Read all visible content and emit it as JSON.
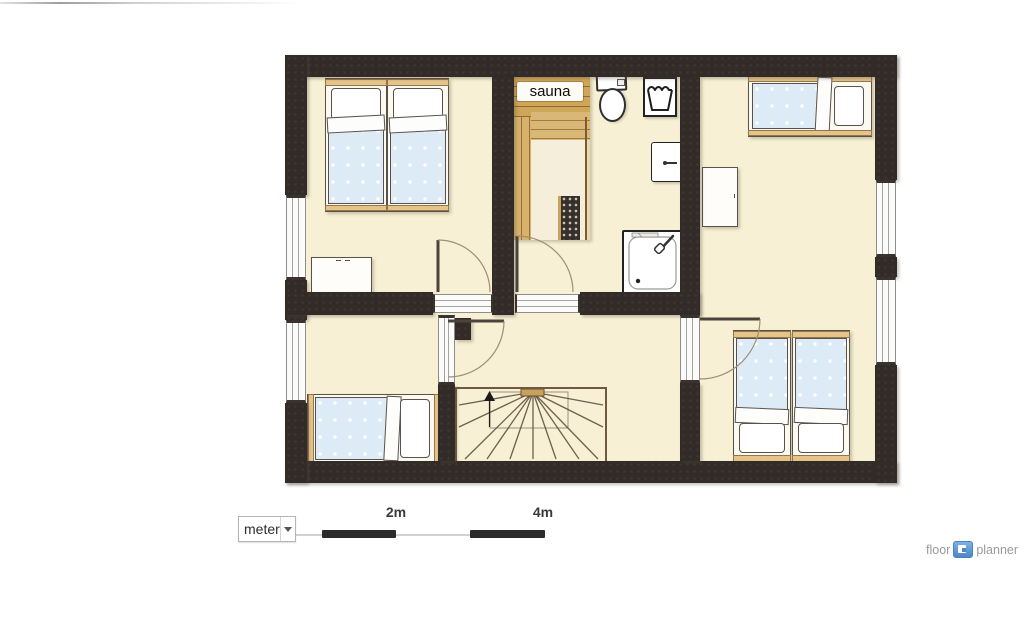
{
  "branding": {
    "floor": "floor",
    "planner": "planner",
    "icon": "floorplanner-logo-icon"
  },
  "scale_bar": {
    "unit_dropdown": {
      "value": "meter",
      "icon": "dropdown-arrow-icon"
    },
    "tick_labels": [
      "2m",
      "4m"
    ]
  },
  "floor_plan": {
    "labels": {
      "sauna": "sauna"
    },
    "rooms": [
      {
        "id": "bedroom-top-left",
        "fixtures": [
          "single-bed",
          "single-bed",
          "dresser",
          "window",
          "door"
        ]
      },
      {
        "id": "bathroom-sauna",
        "fixtures": [
          "sauna-cabin",
          "sauna-heater",
          "toilet",
          "washbasin",
          "wall-cabinet",
          "shower",
          "door"
        ]
      },
      {
        "id": "bedroom-right",
        "fixtures": [
          "single-bed",
          "single-bed",
          "single-bed",
          "desk",
          "window",
          "window",
          "door"
        ]
      },
      {
        "id": "bedroom-bottom-left",
        "fixtures": [
          "single-bed",
          "window",
          "door"
        ]
      },
      {
        "id": "hallway",
        "fixtures": [
          "staircase",
          "up-arrow"
        ]
      }
    ],
    "colors": {
      "wall": "#332b27",
      "floor": "#f7f0d4",
      "bed_blanket": "#dcebf6",
      "wood": "#cfa55e",
      "scale_black": "#2b2b2b",
      "logo_blue": "#4c86c6",
      "logo_gray": "#9a9a9a"
    }
  }
}
